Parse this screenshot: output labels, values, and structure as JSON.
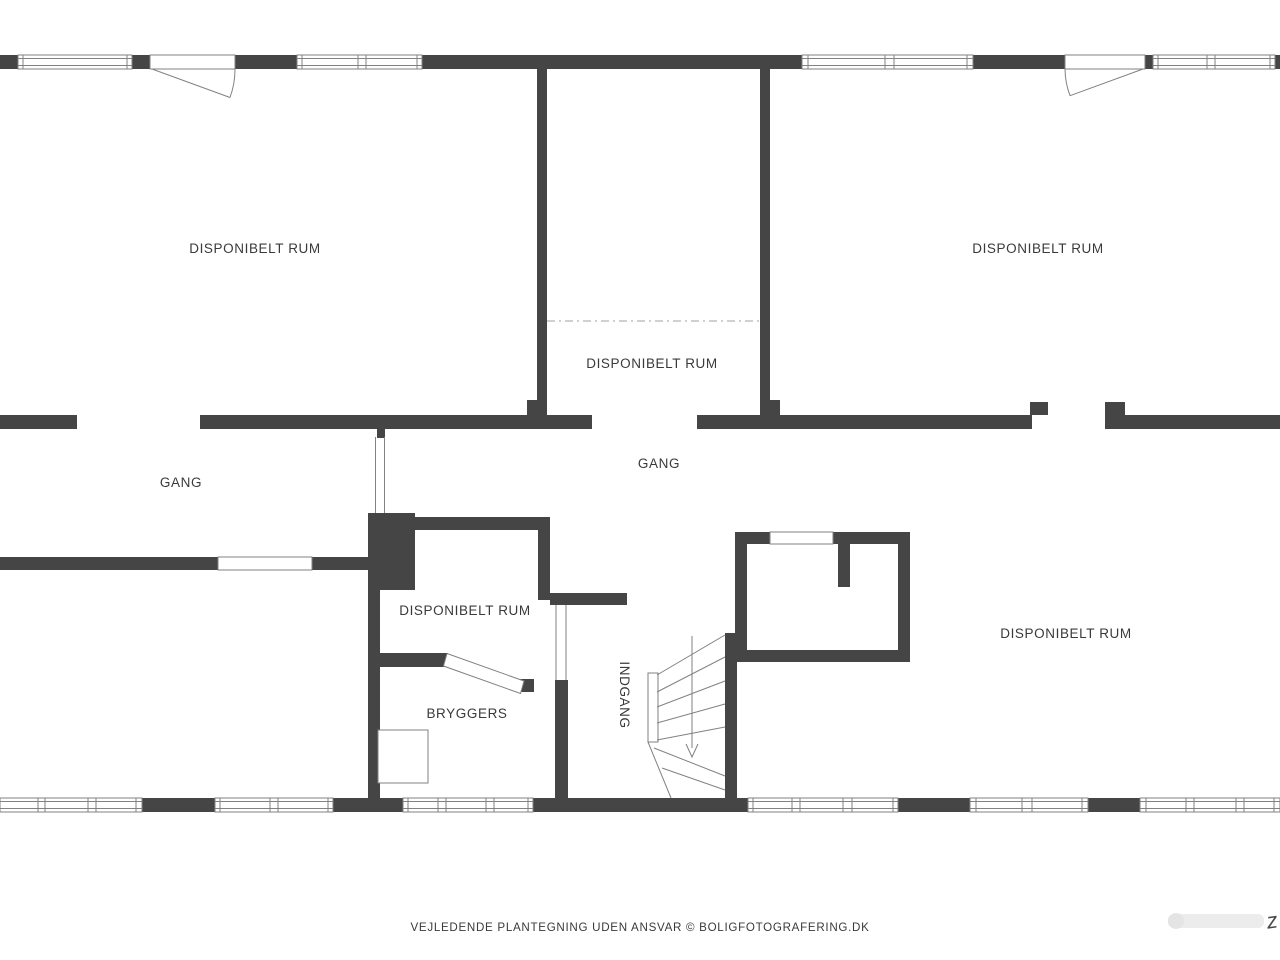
{
  "floor_plan": {
    "rooms": [
      {
        "name": "room-top-left",
        "label": "DISPONIBELT RUM"
      },
      {
        "name": "room-top-middle",
        "label": "DISPONIBELT RUM"
      },
      {
        "name": "room-top-right",
        "label": "DISPONIBELT RUM"
      },
      {
        "name": "hall-left",
        "label": "GANG"
      },
      {
        "name": "hall-right",
        "label": "GANG"
      },
      {
        "name": "room-middle",
        "label": "DISPONIBELT RUM"
      },
      {
        "name": "utility-room",
        "label": "BRYGGERS"
      },
      {
        "name": "room-bottom-right",
        "label": "DISPONIBELT RUM"
      },
      {
        "name": "entrance",
        "label": "INDGANG"
      }
    ],
    "footer_disclaimer": "VEJLEDENDE PLANTEGNING UDEN ANSVAR © BOLIGFOTOGRAFERING.DK",
    "watermark_mark": "z",
    "colors": {
      "wall": "#454545",
      "line": "#828282",
      "light_line": "#b3b3b3",
      "text": "#3a3a3a",
      "background": "#ffffff"
    }
  }
}
